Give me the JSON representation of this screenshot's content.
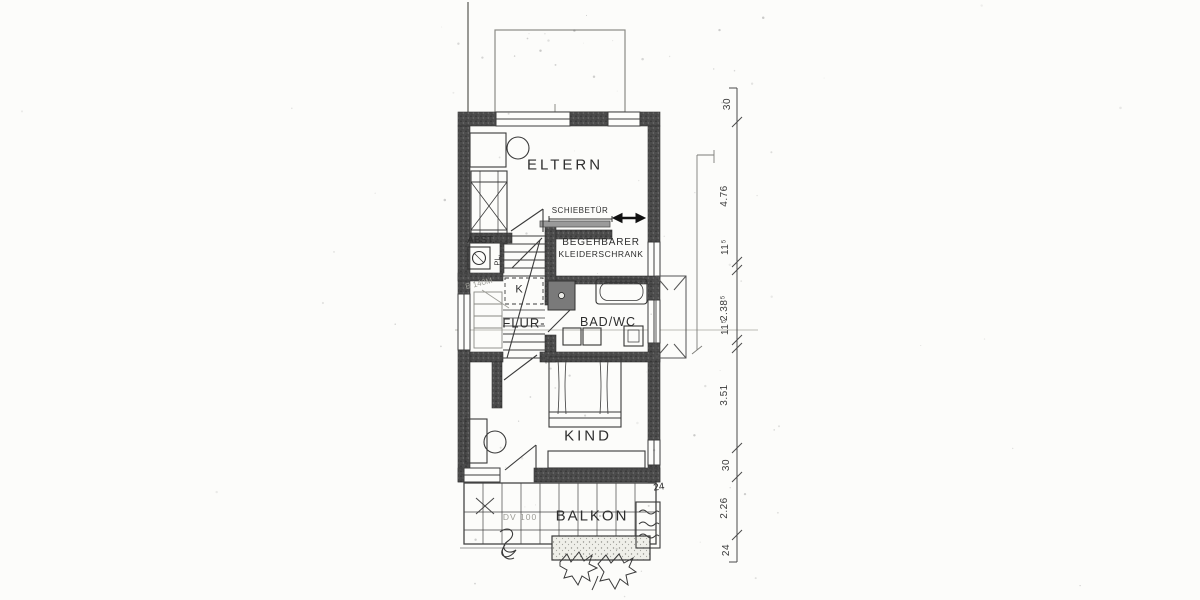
{
  "colors": {
    "paper": "#fcfcfa",
    "ink": "#2e2e2e",
    "wall_fill": "#4c4c4c",
    "faint_annotation": "#9d9d97"
  },
  "labels": {
    "eltern": "ELTERN",
    "kind": "KIND",
    "balkon": "BALKON",
    "bad_wc": "BAD/WC",
    "flur": "FLUR-",
    "abst": "ABST.",
    "pl": "PL.",
    "k": "K",
    "closet_line1": "BEGEHBARER",
    "closet_line2": "KLEIDERSCHRANK",
    "schiebetuer": "SCHIEBETÜR"
  },
  "annotations": {
    "b140": "B 140M",
    "dv100": "DV 100",
    "balcony_wall": "24"
  },
  "dimensions": {
    "chain": [
      "30",
      "4.76",
      "11⁵",
      "2.38⁵",
      "11⁵",
      "3.51",
      "30",
      "2.26",
      "24"
    ]
  }
}
